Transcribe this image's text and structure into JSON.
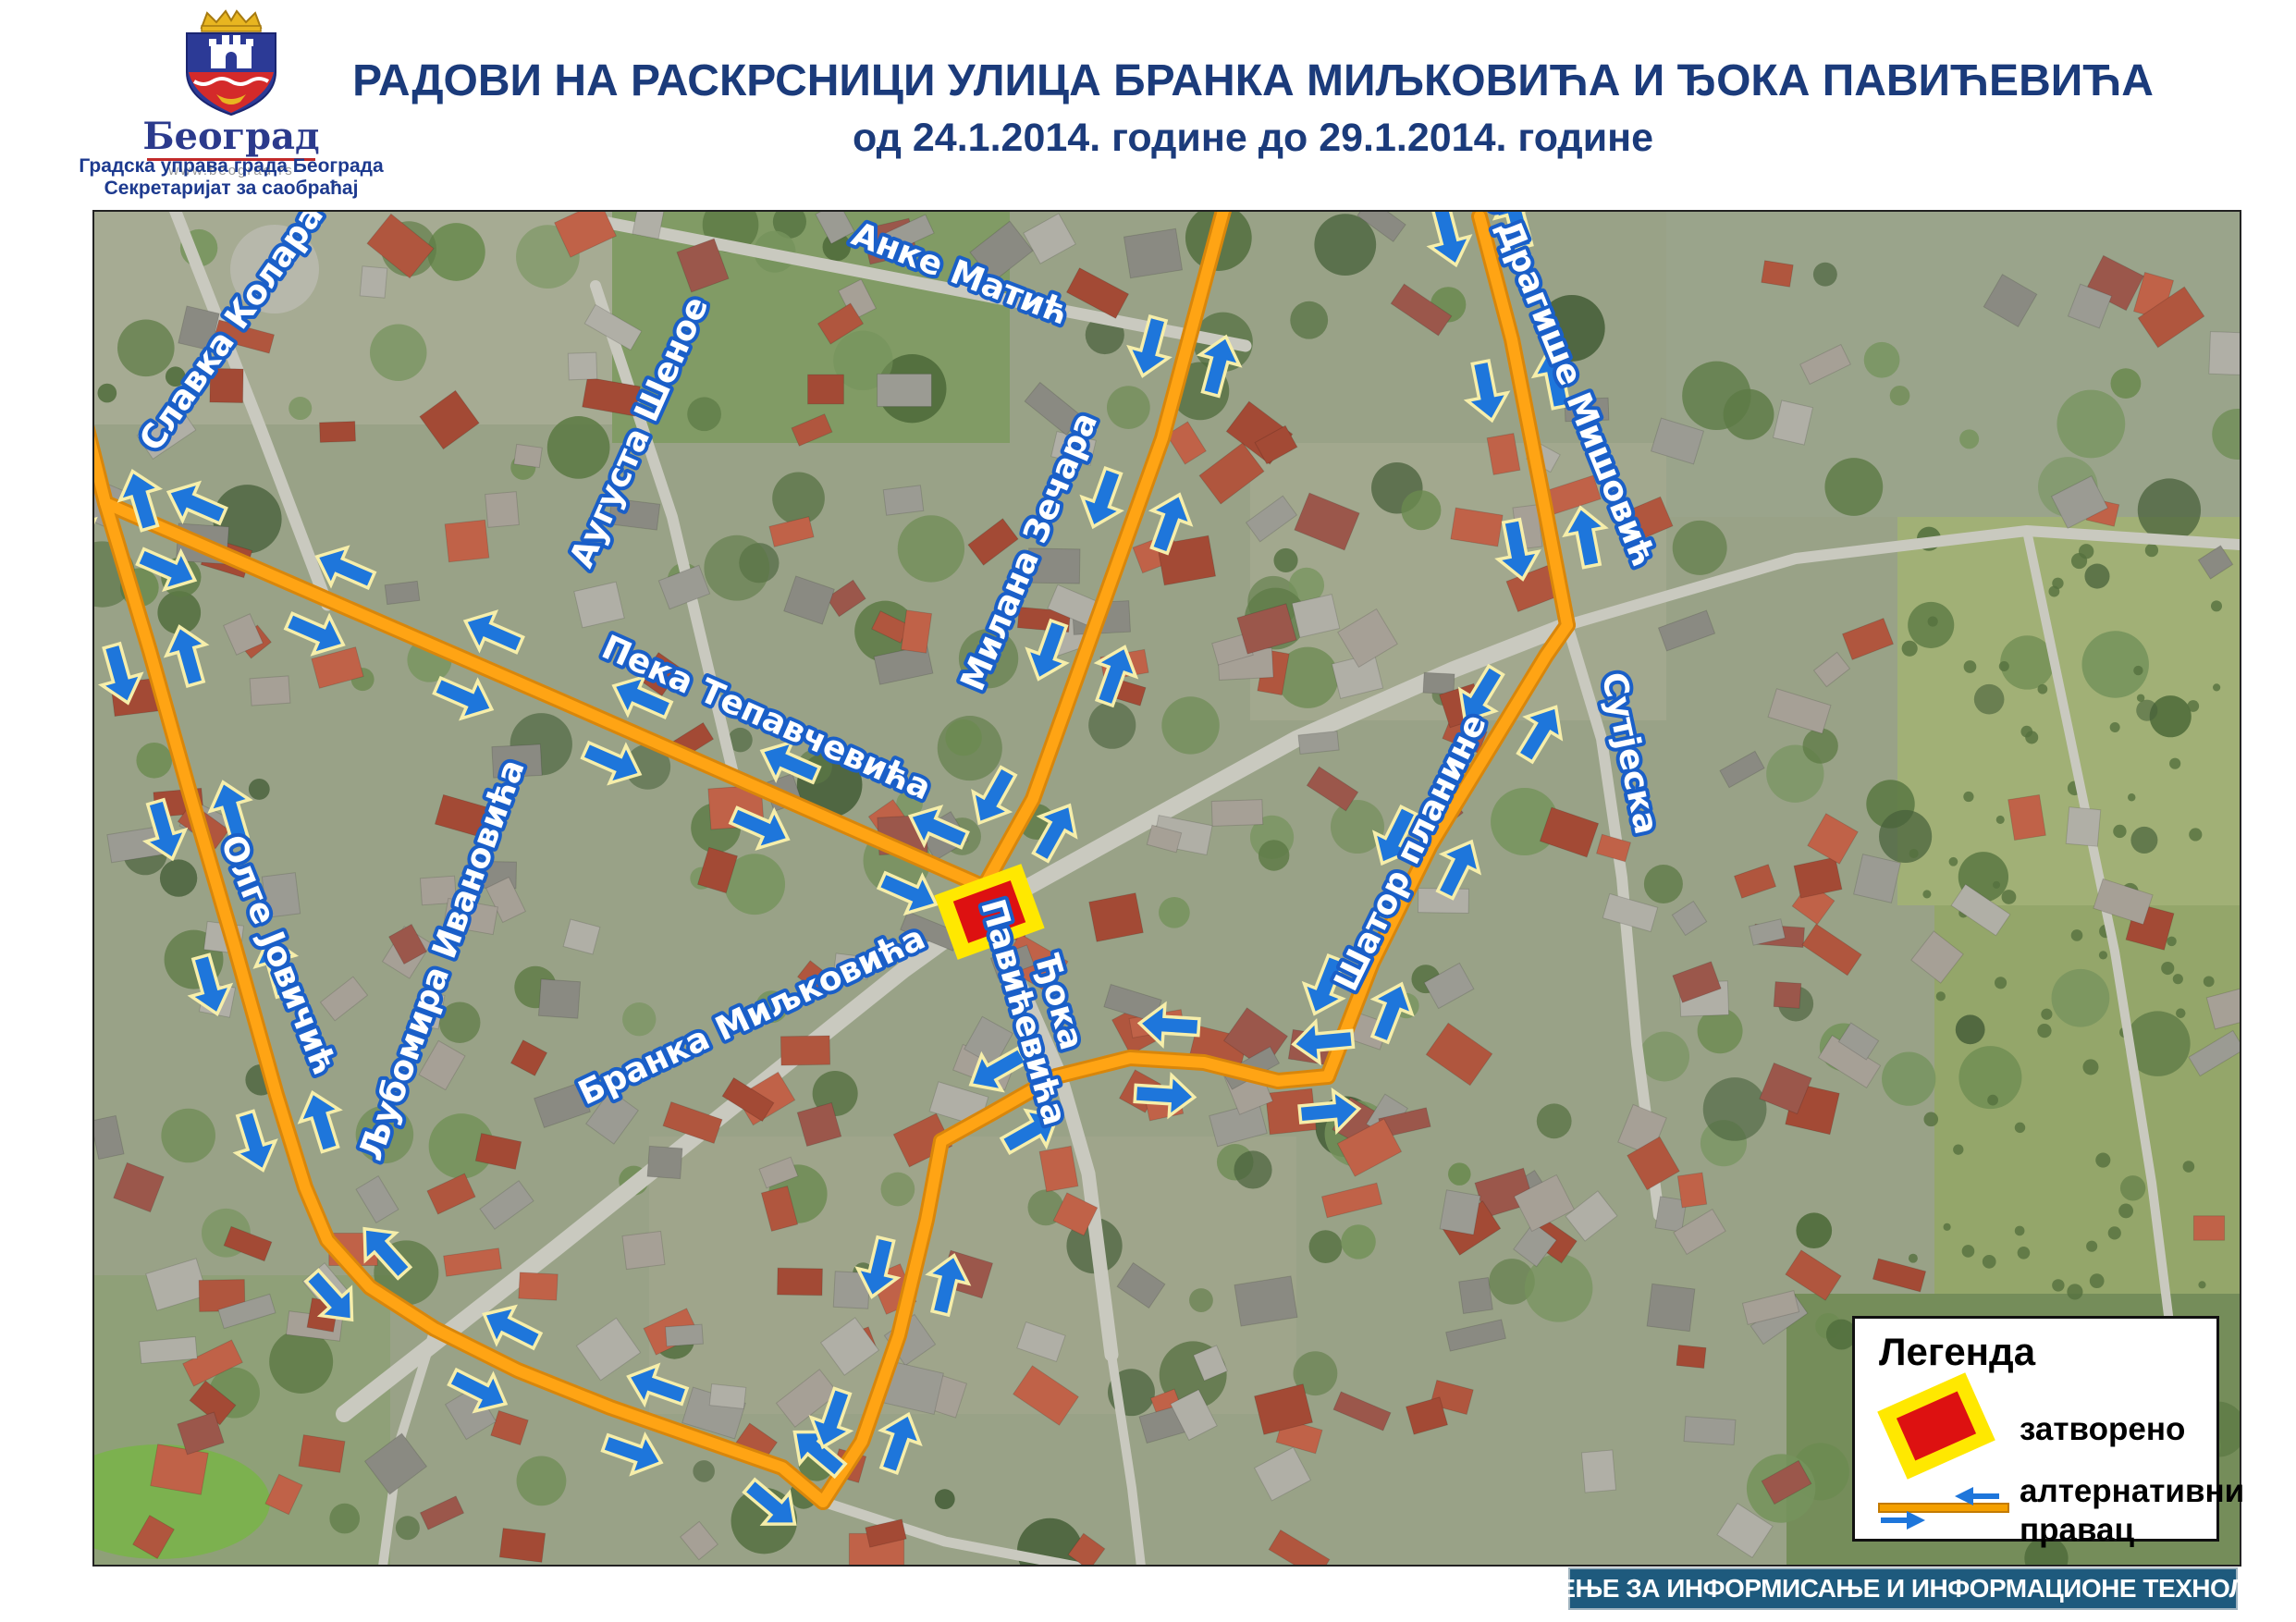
{
  "poster": {
    "logo": {
      "city": "Београд",
      "url": "www.beograd.rs"
    },
    "org": {
      "line1": "Градска управа града Београда",
      "line2": "Секретаријат за саобраћај"
    },
    "title": {
      "line1": "РАДОВИ НА РАСКРСНИЦИ УЛИЦА БРАНКА МИЉКОВИЋА И ЂОКА ПАВИЋЕВИЋА",
      "line2": "од 24.1.2014. године до 29.1.2014. године"
    }
  },
  "map": {
    "type": "aerial-photo with marked closed intersection and alternative routes",
    "street_labels": [
      {
        "name": "Славка Колара"
      },
      {
        "name": "Анке Матић"
      },
      {
        "name": "Аугуста Шеное"
      },
      {
        "name": "Милана Зечара"
      },
      {
        "name": "Др Драгише Мишовић"
      },
      {
        "name": "Пека Тепавчевића"
      },
      {
        "name": "Сутјеска"
      },
      {
        "name": "Шатор планине"
      },
      {
        "name": "Олге Јовичић"
      },
      {
        "name": "Љубомира Ивановића"
      },
      {
        "name": "Бранка Миљковића"
      },
      {
        "name": "Ђока Павићевића",
        "line1": "Ђока",
        "line2": "Павићевића"
      }
    ]
  },
  "legend": {
    "title": "Легенда",
    "items": [
      {
        "label": "затворено"
      },
      {
        "label": "алтернативни правац",
        "line1": "алтернативни",
        "line2": "правац"
      }
    ]
  },
  "footer": {
    "text": "ОДЕЉЕЊЕ ЗА ИНФОРМИСАЊЕ И ИНФОРМАЦИОНЕ ТЕХНОЛОГИЈЕ"
  },
  "colors": {
    "title_navy": "#1b3b7b",
    "route_orange": "#ffa414",
    "route_casing": "#d8860b",
    "arrow_blue": "#1e76db",
    "arrow_outline": "#f6eeaa",
    "street_label_fill": "#ffffff",
    "street_label_stroke": "#1a5fc8",
    "closed_red": "#dd1111",
    "closed_yellow": "#ffe800",
    "footer_teal": "#1e5a7d"
  }
}
